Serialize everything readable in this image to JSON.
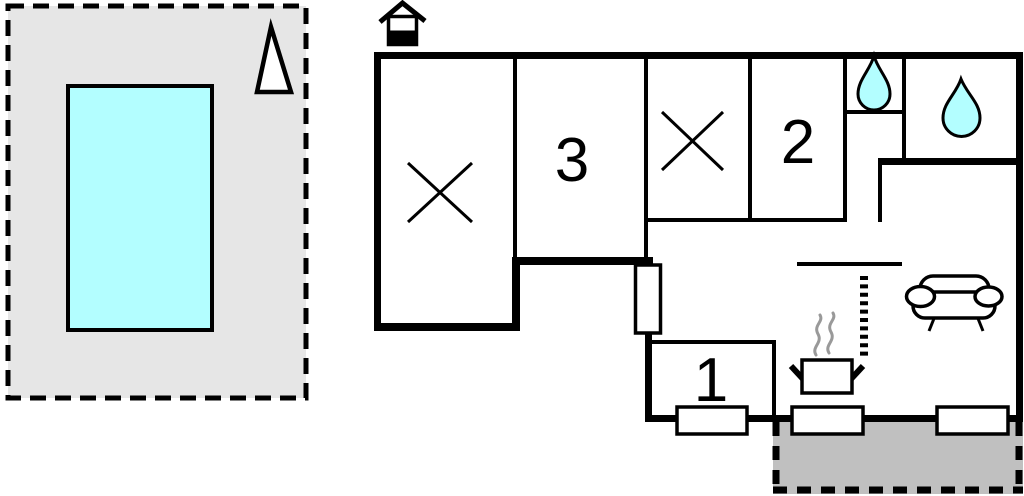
{
  "rooms": [
    {
      "label": "3"
    },
    {
      "label": "2"
    },
    {
      "label": "1"
    }
  ],
  "icons": {
    "entrance": "house-entrance-icon",
    "north_arrow": "north-arrow-icon",
    "pool": "swimming-pool",
    "bed_cross": "bed-cross-icon",
    "water_drop_small": "water-drop-icon",
    "water_drop_large": "water-drop-icon",
    "ladder": "ladder-icon",
    "stove": "stove-pot-icon",
    "steam": "steam-icon",
    "sofa": "sofa-icon",
    "window": "window-icon",
    "patio": "patio-terrace"
  },
  "colors": {
    "line": "#000000",
    "water": "#b3feff",
    "site_area": "#e6e6e6",
    "patio": "#c0c0c0",
    "steam": "#999999",
    "background": "#ffffff"
  }
}
